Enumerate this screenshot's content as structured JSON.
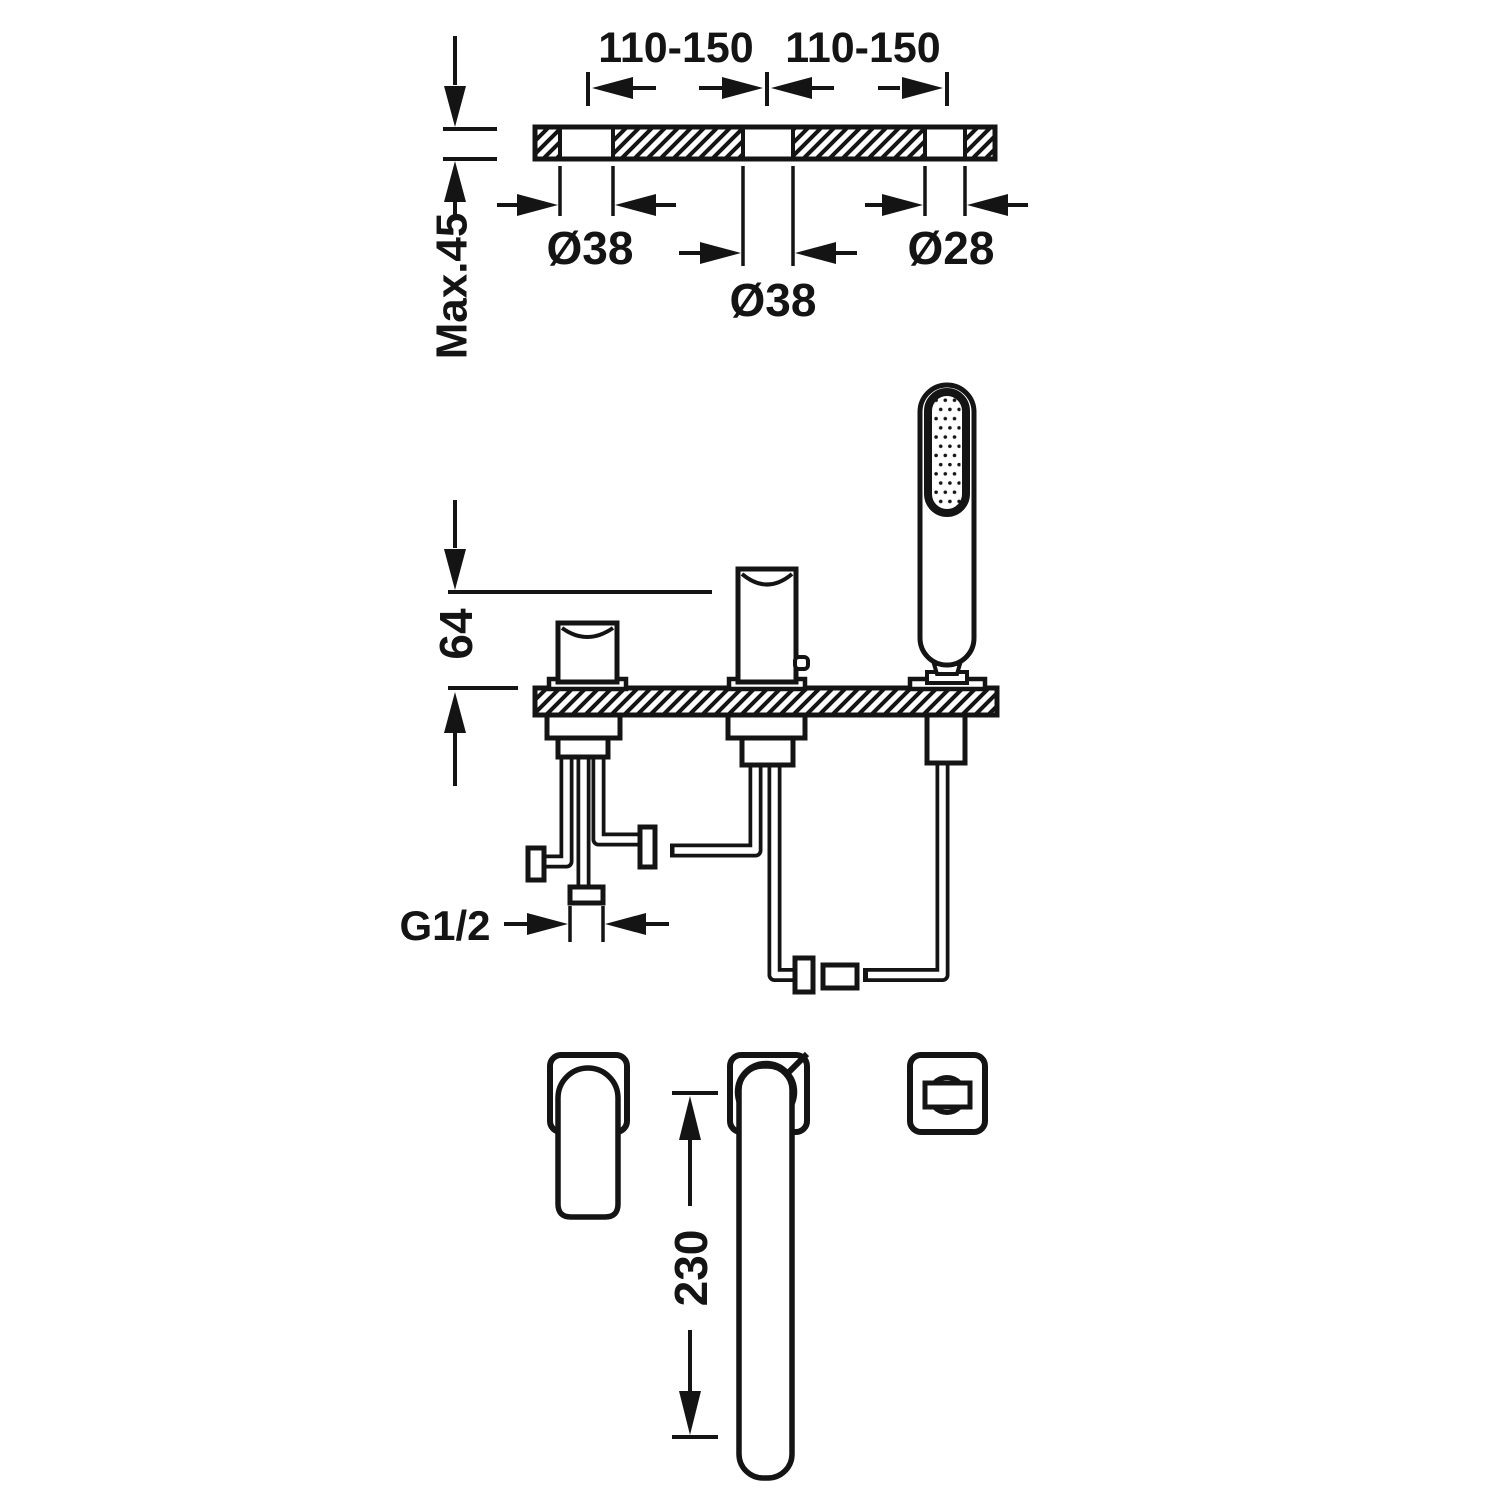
{
  "diagram": {
    "kind": "bath-deck-mixer-installation-drawing",
    "colors": {
      "line": "#141414",
      "background": "#ffffff"
    },
    "dimensions": {
      "hole_spacing_left": "110-150",
      "hole_spacing_right": "110-150",
      "hole_diameter_left": "Ø38",
      "hole_diameter_center": "Ø38",
      "hole_diameter_right": "Ø28",
      "deck_thickness_max": "Max.45",
      "body_height": "64",
      "connection_thread": "G1/2",
      "spout_length": "230"
    }
  }
}
